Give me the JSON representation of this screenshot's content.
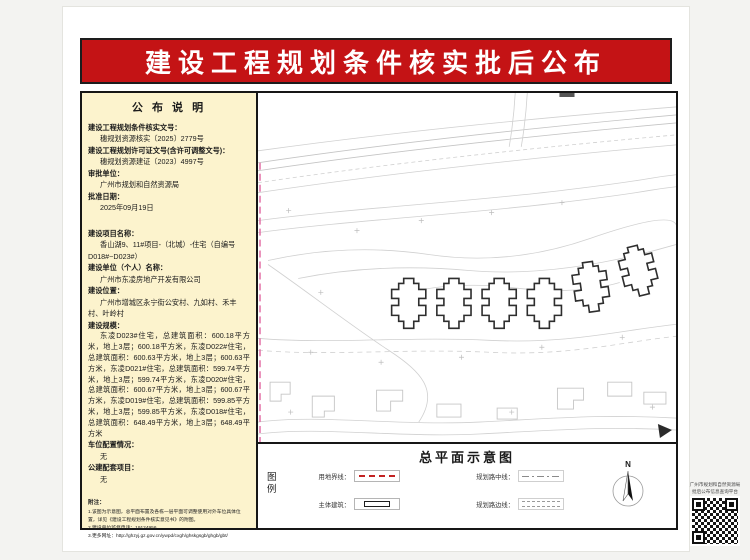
{
  "banner": {
    "title": "建设工程规划条件核实批后公布"
  },
  "info_panel": {
    "title": "公 布 说 明",
    "fields": [
      {
        "label": "建设工程规划条件核实文号：",
        "value": "穗规划资源核实〔2025〕2779号"
      },
      {
        "label": "建设工程规划许可证文号(含许可调整文号)：",
        "value": "穗规划资源建证〔2023〕4997号"
      },
      {
        "label": "审批单位：",
        "value": "广州市规划和自然资源局"
      },
      {
        "label": "批准日期：",
        "value": "2025年09月19日"
      }
    ],
    "project_fields": [
      {
        "label": "建设项目名称：",
        "value": "香山湖9、11#项目-（北城）-住宅（自编号D018#~D023#）"
      },
      {
        "label": "建设单位（个人）名称：",
        "value": "广州市东凌房地产开发有限公司"
      },
      {
        "label": "建设位置：",
        "value": "广州市增城区永宁街公安村、九如村、禾丰村、叶岭村"
      },
      {
        "label": "建设规模：",
        "value": "东凌D023#住宅，总建筑面积：600.18平方米，地上3层；600.18平方米，东凌D022#住宅，总建筑面积：600.63平方米，地上3层；600.63平方米，东凌D021#住宅，总建筑面积：599.74平方米，地上3层；599.74平方米，东凌D020#住宅，总建筑面积：600.67平方米，地上3层；600.67平方米，东凌D019#住宅，总建筑面积：599.85平方米，地上3层；599.85平方米，东凌D018#住宅，总建筑面积：648.49平方米，地上3层；648.49平方米"
      },
      {
        "label": "车位配置情况：",
        "value": "无"
      },
      {
        "label": "公建配套项目：",
        "value": "无"
      }
    ],
    "notes_title": "附注：",
    "notes": [
      "1.该图为示意图，总平面布置及各栋一层平面可调整使用对外车位具体位置，详见《建设工程规划条件核实意见书》的附图。",
      "2.建设单位监督电话：19124956",
      "3.更多网址：http://ghzyj.gz.gov.cn/ywpd/cxgh/ghskgsgb/ghgb/gbt/"
    ]
  },
  "plan_panel": {
    "title": "总平面示意图",
    "legend_label": "图例",
    "legend": [
      {
        "label": "用地界线："
      },
      {
        "label": "主体建筑："
      },
      {
        "label": "规划路中线："
      },
      {
        "label": "规划路边线："
      }
    ],
    "north_label": "N"
  },
  "qr": {
    "line1": "广州市规划和自然资源局",
    "line2": "批后公布信息查询平台"
  },
  "colors": {
    "banner_red": "#c41315",
    "panel_yellow": "#fcf3cd",
    "boundary_pink": "#e268a2",
    "legend_red": "#c32222"
  }
}
